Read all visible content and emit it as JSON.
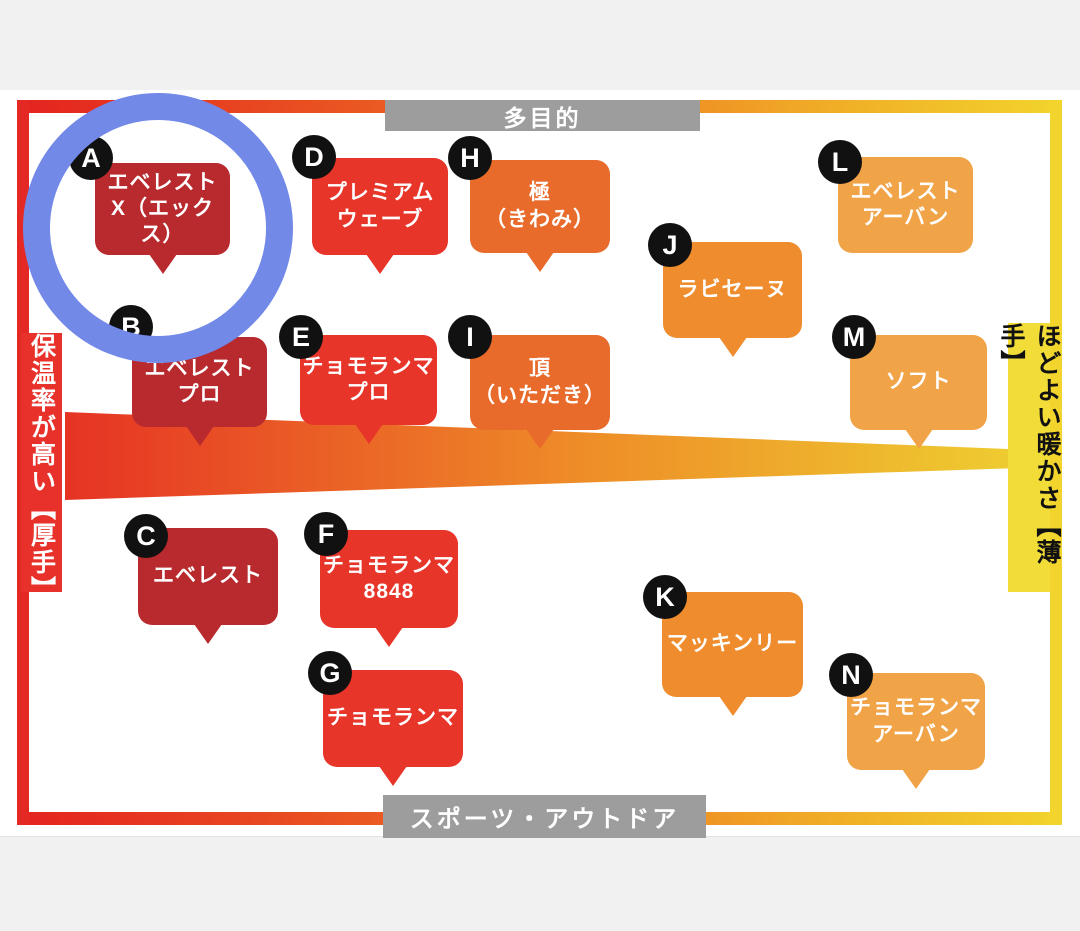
{
  "labels": {
    "top": "多目的",
    "bottom": "スポーツ・アウトドア",
    "left": "保温率が高い【厚手】",
    "right": "ほどよい暖かさ【薄手】"
  },
  "highlight": {
    "shape": "circle",
    "highlighted_product": "A",
    "color": "#7289e8"
  },
  "tier_colors": {
    "dark_red": "#b92a2e",
    "red": "#e8352a",
    "vermilion": "#e86b2b",
    "orange": "#ee8c2e",
    "light_orange": "#f0a347"
  },
  "products": [
    {
      "letter": "A",
      "name": "エベレスト X（エックス）",
      "lines": [
        "エベレスト",
        "X（エックス）"
      ],
      "tier": "dark_red",
      "x": 95,
      "y": 163,
      "w": 135,
      "h": 92,
      "tail": true,
      "bx": 69,
      "by": 136
    },
    {
      "letter": "B",
      "name": "エベレスト プロ",
      "lines": [
        "エベレスト",
        "プロ"
      ],
      "tier": "dark_red",
      "x": 132,
      "y": 337,
      "w": 135,
      "h": 90,
      "tail": true,
      "bx": 109,
      "by": 305
    },
    {
      "letter": "C",
      "name": "エベレスト",
      "lines": [
        "エベレスト"
      ],
      "tier": "dark_red",
      "x": 138,
      "y": 528,
      "w": 140,
      "h": 97,
      "tail": true,
      "bx": 124,
      "by": 514
    },
    {
      "letter": "D",
      "name": "プレミアム ウェーブ",
      "lines": [
        "プレミアム",
        "ウェーブ"
      ],
      "tier": "red",
      "x": 312,
      "y": 158,
      "w": 136,
      "h": 97,
      "tail": true,
      "bx": 292,
      "by": 135
    },
    {
      "letter": "E",
      "name": "チョモランマ プロ",
      "lines": [
        "チョモランマ",
        "プロ"
      ],
      "tier": "red",
      "x": 300,
      "y": 335,
      "w": 137,
      "h": 90,
      "tail": true,
      "bx": 279,
      "by": 315
    },
    {
      "letter": "F",
      "name": "チョモランマ 8848",
      "lines": [
        "チョモランマ",
        "8848"
      ],
      "tier": "red",
      "x": 320,
      "y": 530,
      "w": 138,
      "h": 98,
      "tail": true,
      "bx": 304,
      "by": 512
    },
    {
      "letter": "G",
      "name": "チョモランマ",
      "lines": [
        "チョモランマ"
      ],
      "tier": "red",
      "x": 323,
      "y": 670,
      "w": 140,
      "h": 97,
      "tail": true,
      "bx": 308,
      "by": 651
    },
    {
      "letter": "H",
      "name": "極（きわみ）",
      "lines": [
        "極",
        "（きわみ）"
      ],
      "tier": "vermilion",
      "x": 470,
      "y": 160,
      "w": 140,
      "h": 93,
      "tail": true,
      "bx": 448,
      "by": 136
    },
    {
      "letter": "I",
      "name": "頂（いただき）",
      "lines": [
        "頂",
        "（いただき）"
      ],
      "tier": "vermilion",
      "x": 470,
      "y": 335,
      "w": 140,
      "h": 95,
      "tail": true,
      "bx": 448,
      "by": 315
    },
    {
      "letter": "J",
      "name": "ラビセーヌ",
      "lines": [
        "ラビセーヌ"
      ],
      "tier": "orange",
      "x": 663,
      "y": 242,
      "w": 139,
      "h": 96,
      "tail": true,
      "bx": 648,
      "by": 223
    },
    {
      "letter": "K",
      "name": "マッキンリー",
      "lines": [
        "マッキンリー"
      ],
      "tier": "orange",
      "x": 662,
      "y": 592,
      "w": 141,
      "h": 105,
      "tail": true,
      "bx": 643,
      "by": 575
    },
    {
      "letter": "L",
      "name": "エベレスト アーバン",
      "lines": [
        "エベレスト",
        "アーバン"
      ],
      "tier": "light_orange",
      "x": 838,
      "y": 157,
      "w": 135,
      "h": 96,
      "tail": false,
      "bx": 818,
      "by": 140
    },
    {
      "letter": "M",
      "name": "ソフト",
      "lines": [
        "ソフト"
      ],
      "tier": "light_orange",
      "x": 850,
      "y": 335,
      "w": 137,
      "h": 95,
      "tail": true,
      "bx": 832,
      "by": 315
    },
    {
      "letter": "N",
      "name": "チョモランマ アーバン",
      "lines": [
        "チョモランマ",
        "アーバン"
      ],
      "tier": "light_orange",
      "x": 847,
      "y": 673,
      "w": 138,
      "h": 97,
      "tail": true,
      "bx": 829,
      "by": 653
    }
  ]
}
